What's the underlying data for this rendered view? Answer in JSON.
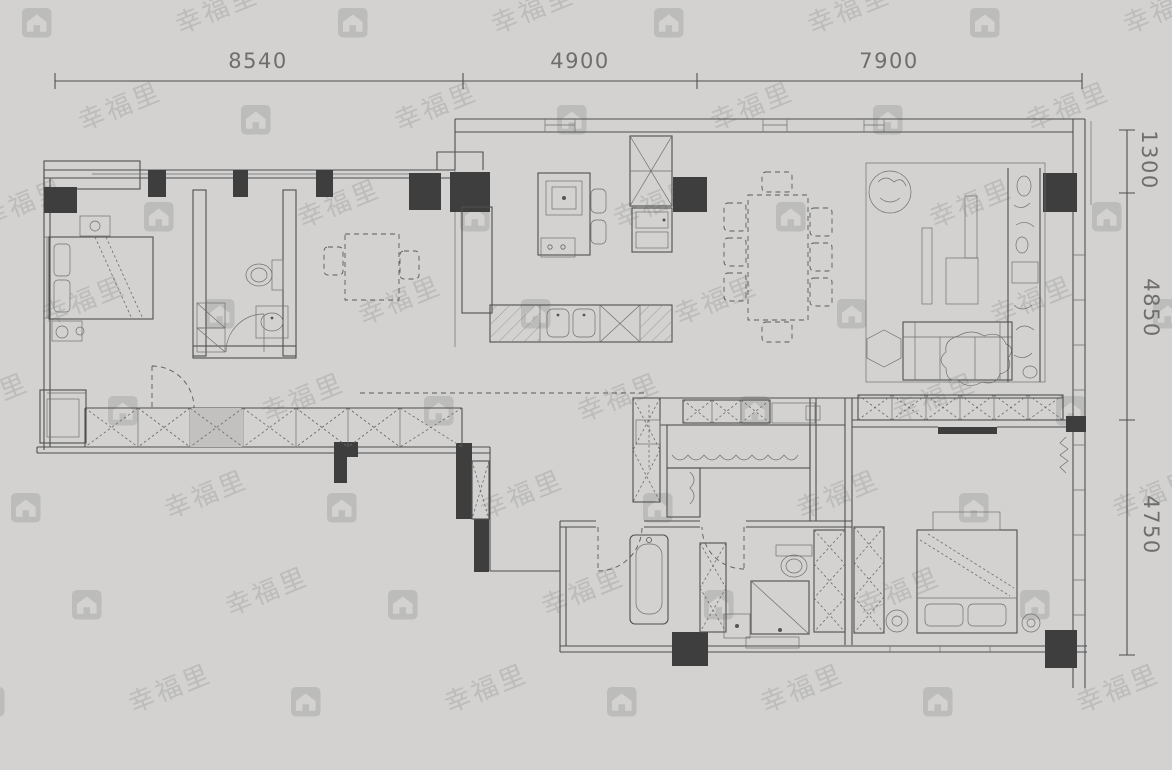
{
  "page": {
    "background": "#d3d2d0",
    "line_color": "#4f4f4f",
    "dark_fill": "#3e3e3e",
    "dim_text_color": "#6e6e6e"
  },
  "plan": {
    "dimensions_top": [
      {
        "label": "8540"
      },
      {
        "label": "4900"
      },
      {
        "label": "7900"
      }
    ],
    "dimensions_right": [
      {
        "label": "1300"
      },
      {
        "label": "4850"
      },
      {
        "label": "4750"
      }
    ]
  },
  "watermark": {
    "brand_text": "幸福里",
    "icon": "house-logo",
    "color": "#9d9d9d",
    "opacity": 0.42
  }
}
